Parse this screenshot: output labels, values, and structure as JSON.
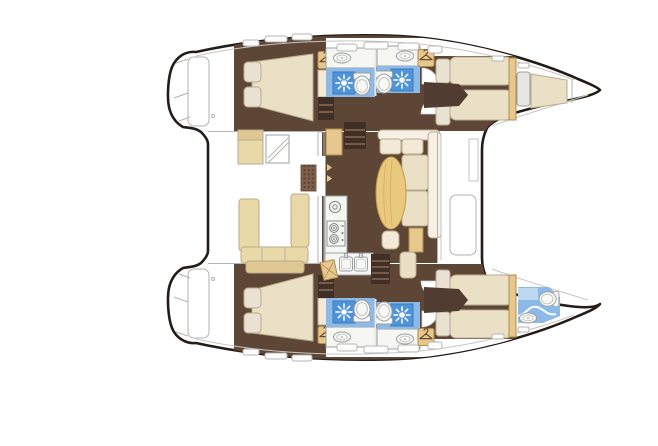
{
  "title": "Catamaran interior layout floor plan (no visible text in drawing)",
  "canvas": {
    "width": 658,
    "height": 446,
    "background": "#ffffff"
  },
  "colors": {
    "outline": "#221d18",
    "hullFloor": "#5d4636",
    "wallDark": "#46342a",
    "stepsDark": "#3f2f26",
    "cream": "#eae0c6",
    "creamLight": "#f2ead6",
    "pillow": "#e9e1d1",
    "settBack": "#f6f1e4",
    "tan": "#e6c78e",
    "tableWood": "#eac87c",
    "benchCream": "#ead9a8",
    "benchBack": "#dfc892",
    "blueFloor": "#8db9e6",
    "blueLight": "#bcd9f1",
    "showerTile": "#4f93d9",
    "fixtureWhite": "#f8f8f6",
    "counterWhite": "#f6f6f3",
    "seatGrey": "#e6e6e2",
    "grate": "#7d5e49",
    "grateDot": "#4e3a2d",
    "white": "#ffffff"
  },
  "legend": {
    "hulls": [
      "port-hull-top",
      "starboard-hull-bottom"
    ],
    "rooms": [
      "aft-cabin",
      "aft-head",
      "forward-head",
      "forward-cabin",
      "bow-berth",
      "bow-head",
      "cockpit",
      "salon",
      "galley"
    ],
    "fixture_icons": {
      "shower-icon": "sun-burst tile",
      "toilet-icon": "tank + oval bowl",
      "sink-icon": "oval basin",
      "wardrobe-icon": "clothes hanger",
      "stove-icon": "burner circles",
      "stairs-icon": "treaded steps",
      "hatch-icon": "rounded deck hatch"
    }
  }
}
